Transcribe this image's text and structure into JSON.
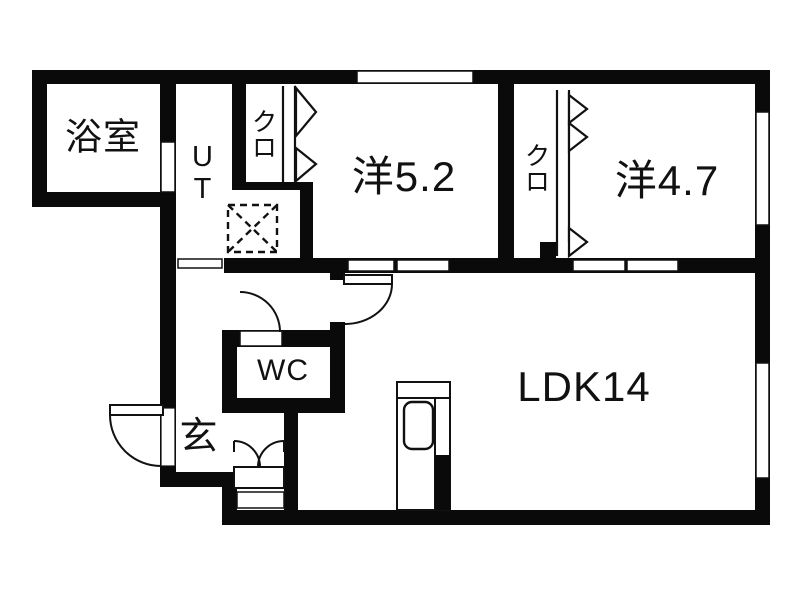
{
  "floorplan": {
    "type": "apartment-floor-plan",
    "layout_name": "2LDK",
    "colors": {
      "wall": "#0a0a0a",
      "floor": "#ffffff",
      "background": "#ffffff",
      "line": "#111111"
    },
    "rooms": [
      {
        "id": "bathroom",
        "label": "浴室",
        "orientation": "horizontal"
      },
      {
        "id": "utility",
        "label": "UT",
        "orientation": "vertical"
      },
      {
        "id": "closet-1",
        "label": "クロ",
        "orientation": "vertical"
      },
      {
        "id": "bedroom-1",
        "label": "洋5.2",
        "orientation": "horizontal"
      },
      {
        "id": "closet-2",
        "label": "クロ",
        "orientation": "vertical"
      },
      {
        "id": "bedroom-2",
        "label": "洋4.7",
        "orientation": "horizontal"
      },
      {
        "id": "wc",
        "label": "WC",
        "orientation": "horizontal"
      },
      {
        "id": "entrance",
        "label": "玄",
        "orientation": "horizontal"
      },
      {
        "id": "ldk",
        "label": "LDK14",
        "orientation": "horizontal"
      }
    ],
    "symbols": [
      "hinged-door-arc-entrance",
      "hinged-door-arc-wc",
      "hinged-door-arc-ldk",
      "double-door-shoe-cabinet",
      "bifold-closet-door-triangles-x2",
      "sliding-door-pair-bedroom1-ldk",
      "sliding-door-pair-bedroom2-ldk",
      "window-top-wall",
      "window-right-wall-bedroom2",
      "window-right-wall-ldk",
      "washing-machine-dashed-box",
      "kitchen-counter-with-sink",
      "utility-passage-opening",
      "bathroom-sliding-door",
      "porch-opening"
    ]
  }
}
